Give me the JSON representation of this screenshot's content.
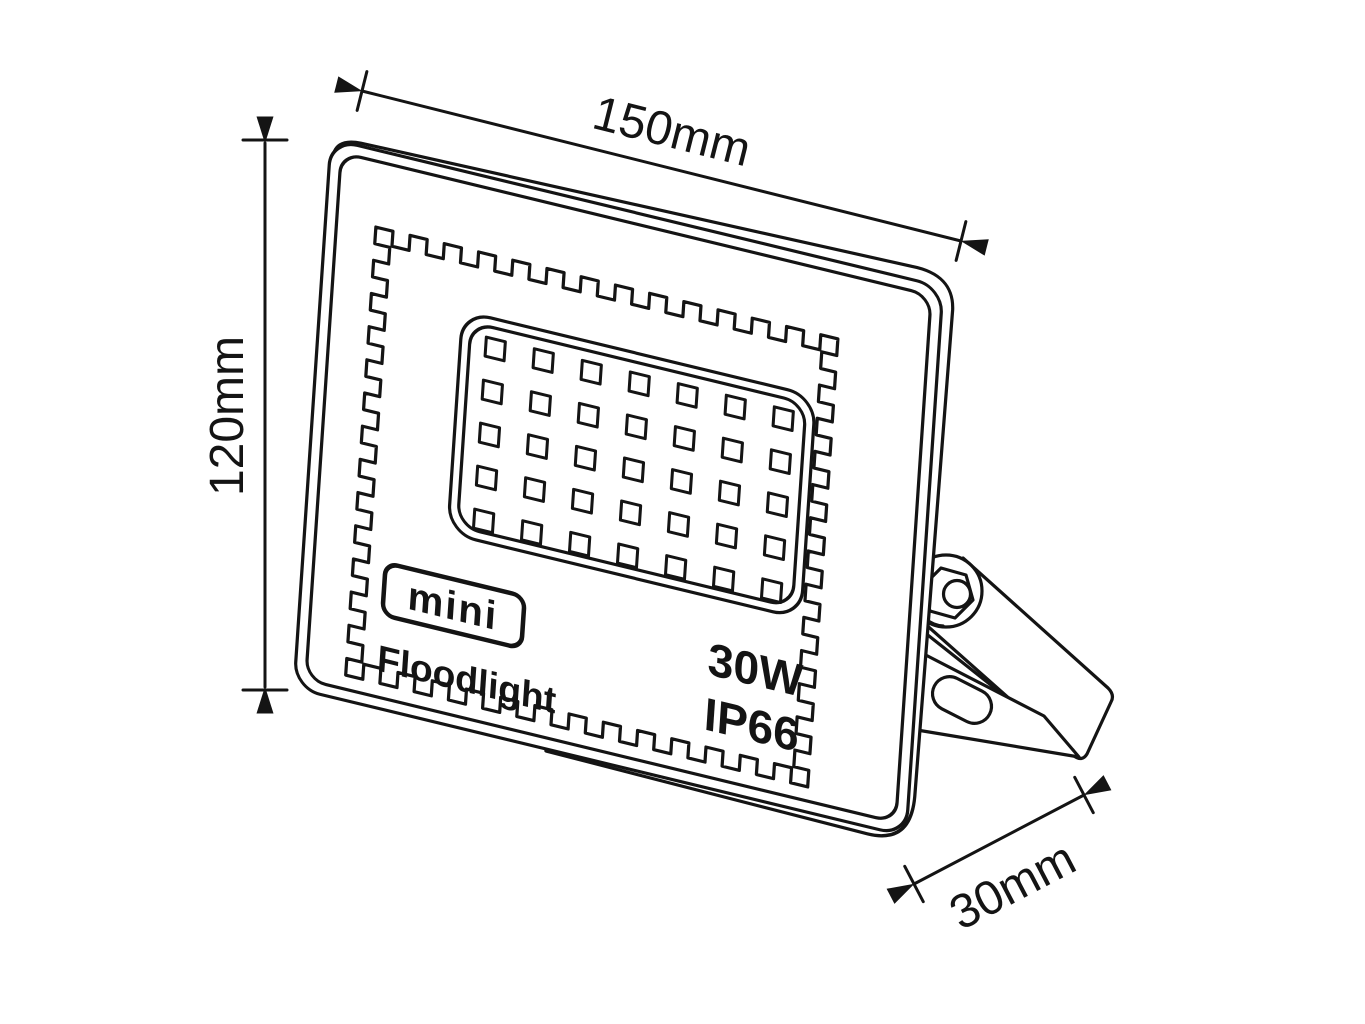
{
  "figure": {
    "type": "technical-line-drawing",
    "subject": "mini LED floodlight with mounting bracket"
  },
  "dimensions": {
    "width": "150mm",
    "height": "120mm",
    "depth": "30mm"
  },
  "product": {
    "brand": "mini",
    "name": "Floodlight",
    "wattage": "30W",
    "ip_rating": "IP66"
  },
  "led_grid": {
    "columns": 7,
    "rows": 5
  },
  "colors": {
    "line": "#141414",
    "background": "#ffffff"
  }
}
